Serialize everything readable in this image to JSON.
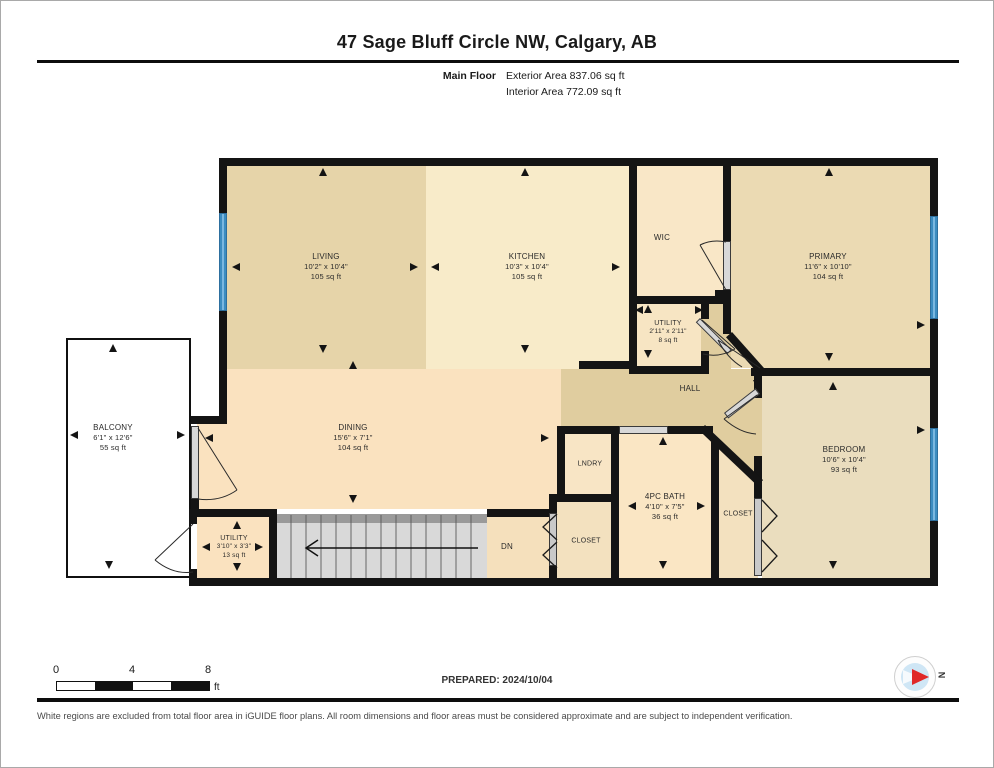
{
  "header": {
    "title": "47 Sage Bluff Circle NW, Calgary, AB",
    "floor_label": "Main Floor",
    "exterior_area": "Exterior Area 837.06 sq ft",
    "interior_area": "Interior Area 772.09 sq ft"
  },
  "rooms": {
    "living": {
      "name": "LIVING",
      "dims": "10'2\" x 10'4\"",
      "area": "105 sq ft"
    },
    "kitchen": {
      "name": "KITCHEN",
      "dims": "10'3\" x 10'4\"",
      "area": "105 sq ft"
    },
    "wic": {
      "name": "WIC"
    },
    "primary": {
      "name": "PRIMARY",
      "dims": "11'6\" x 10'10\"",
      "area": "104 sq ft"
    },
    "utility_top": {
      "name": "UTILITY",
      "dims": "2'11\" x 2'11\"",
      "area": "8 sq ft"
    },
    "hall": {
      "name": "HALL"
    },
    "dining": {
      "name": "DINING",
      "dims": "15'6\" x 7'1\"",
      "area": "104 sq ft"
    },
    "balcony": {
      "name": "BALCONY",
      "dims": "6'1\" x 12'6\"",
      "area": "55 sq ft"
    },
    "laundry": {
      "name": "LNDRY"
    },
    "bath": {
      "name": "4PC BATH",
      "dims": "4'10\" x 7'5\"",
      "area": "36 sq ft"
    },
    "closet_mid": {
      "name": "CLOSET"
    },
    "closet_right": {
      "name": "CLOSET"
    },
    "bedroom": {
      "name": "BEDROOM",
      "dims": "10'6\" x 10'4\"",
      "area": "93 sq ft"
    },
    "utility_bottom": {
      "name": "UTILITY",
      "dims": "3'10\" x 3'3\"",
      "area": "13 sq ft"
    }
  },
  "stairs": {
    "down_label": "DN"
  },
  "footer": {
    "prepared": "PREPARED: 2024/10/04",
    "scale": {
      "ticks": [
        "0",
        "4",
        "8"
      ],
      "unit": "ft"
    },
    "compass_label": "N",
    "disclaimer": "White regions are excluded from total floor area in iGUIDE floor plans. All room dimensions and floor areas must be considered approximate and are subject to independent verification."
  },
  "colors": {
    "wall": "#141414",
    "window_blue": "#5aa7da",
    "door_gray": "#d8d8d8",
    "stair_gray": "#d9d9d9",
    "living": "#e6d4a9",
    "kitchen": "#f8ebc9",
    "wic": "#f9e7c7",
    "primary": "#ebdab3",
    "utility_top": "#f7e5c3",
    "hall": "#e0cd9f",
    "dining": "#fae2bf",
    "laundry": "#f8e5c5",
    "bath": "#fae6c4",
    "closet": "#f3e1bf",
    "bedroom": "#eaddbe",
    "utility_bottom": "#fae2bf",
    "balcony": "#ffffff",
    "compass_red": "#e02828",
    "compass_blue": "#cfe6f5"
  }
}
